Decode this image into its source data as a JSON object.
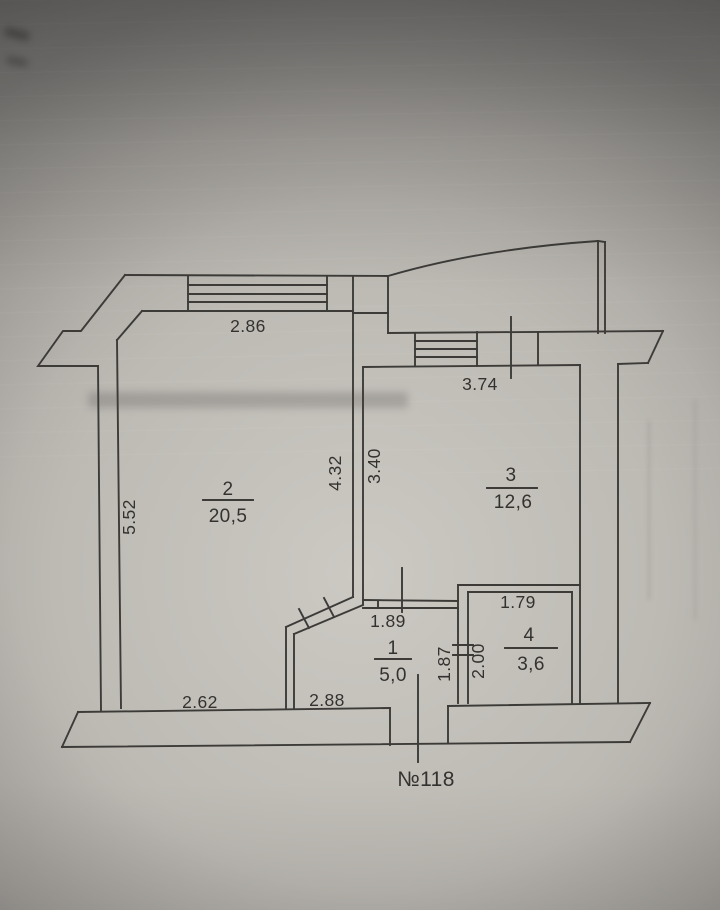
{
  "floor_plan": {
    "apartment_number": "№118",
    "rooms": [
      {
        "number": "2",
        "area": "20,5"
      },
      {
        "number": "3",
        "area": "12,6"
      },
      {
        "number": "1",
        "area": "5,0"
      },
      {
        "number": "4",
        "area": "3,6"
      }
    ],
    "dimensions": {
      "room2_top_window": "2.86",
      "room3_top_window": "3.74",
      "room2_left_wall": "5.52",
      "room2_right_wall": "4.32",
      "room3_left_wall": "3.40",
      "room1_top": "1.89",
      "room4_top": "1.79",
      "room1_right": "1.87",
      "room4_left": "2.00",
      "room2_bottom": "2.62",
      "room1_bottom": "2.88"
    },
    "colors": {
      "paper_light": "#ccc9c3",
      "paper_dark": "#757370",
      "ink": "#3c3b38"
    }
  }
}
